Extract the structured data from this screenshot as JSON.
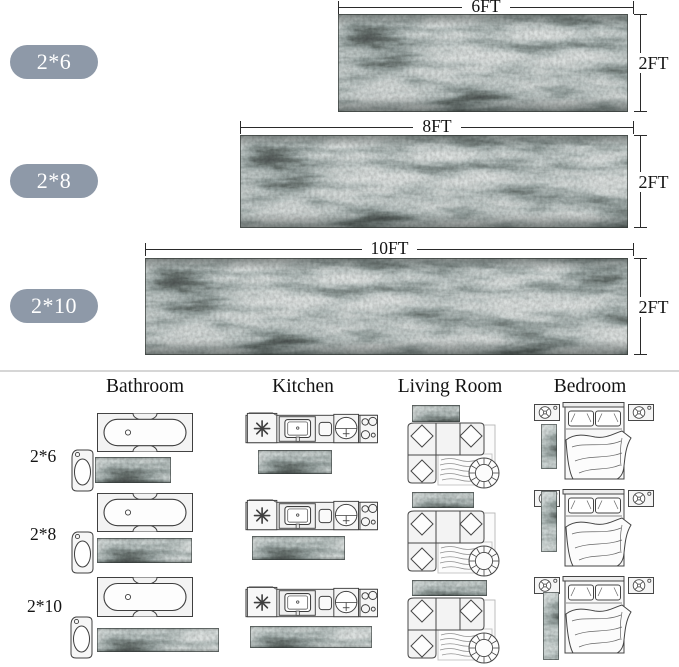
{
  "colors": {
    "badge_bg": "#8e99a8",
    "badge_text": "#ffffff",
    "dimension_line": "#2a2a2a",
    "divider": "#d6d6d6",
    "rug_palette": [
      "#2e3533",
      "#93a7a4",
      "#ccd2ce"
    ]
  },
  "size_guide": {
    "rows": [
      {
        "size_label": "2*6",
        "length_label": "6FT",
        "width_label": "2FT"
      },
      {
        "size_label": "2*8",
        "length_label": "8FT",
        "width_label": "2FT"
      },
      {
        "size_label": "2*10",
        "length_label": "10FT",
        "width_label": "2FT"
      }
    ]
  },
  "room_placement": {
    "column_headers": [
      "Bathroom",
      "Kitchen",
      "Living Room",
      "Bedroom"
    ],
    "row_labels": [
      "2*6",
      "2*8",
      "2*10"
    ],
    "furniture_icons": [
      "bathtub-icon",
      "pedestal-sink-icon",
      "kitchen-counter-icon",
      "sectional-sofa-icon",
      "round-chair-icon",
      "bed-icon",
      "nightstand-fan-icon",
      "rug-texture-swatch"
    ]
  }
}
